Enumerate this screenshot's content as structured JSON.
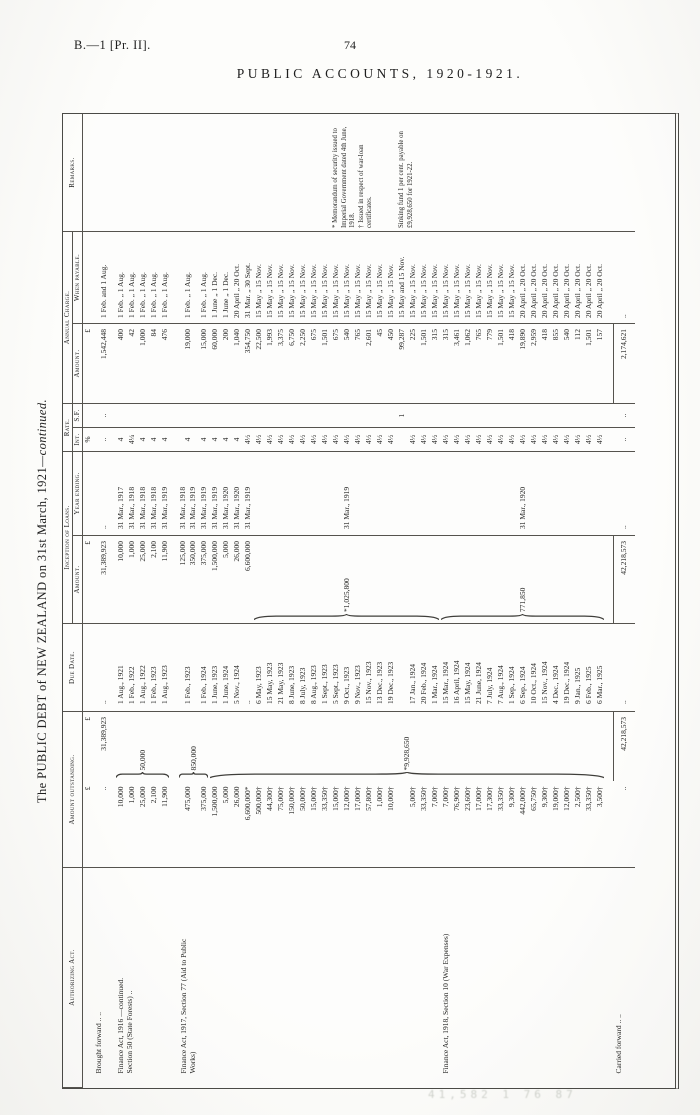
{
  "page": {
    "doc_ref": "B.—1 [Pr. II].",
    "page_number": "74",
    "accounts_heading": "PUBLIC ACCOUNTS, 1920-1921.",
    "artifact_text": "41,582 1 76 87"
  },
  "title": {
    "main": "The PUBLIC DEBT of NEW ZEALAND on 31st March, 1921",
    "continued": "—continued."
  },
  "table": {
    "headers": {
      "authorizing_act": "Authorizing Act.",
      "amount_outstanding": "Amount outstanding.",
      "due_date": "Due Date.",
      "inception_of_loans": "Inception of Loans.",
      "inception_amount": "Amount.",
      "year_ending": "Year ending.",
      "rate": "Rate.",
      "rate_int": "Int.",
      "rate_sf": "S.F.",
      "annual_charge": "Annual Charge.",
      "charge_amount": "Amount.",
      "when_payable": "When payable.",
      "remarks": "Remarks."
    },
    "rows": [
      {
        "cls": "units",
        "amt": "£",
        "tot": "£",
        "inc": "£",
        "ri": "%",
        "ch": "£"
      },
      {
        "cls": "tall1",
        "act": "Brought forward  ..  ..",
        "amt": "..",
        "tot": {
          "t": "31,389,923"
        },
        "due": "..",
        "inc": {
          "t": "31,389,923"
        },
        "yr": "..",
        "ri": "..",
        "rs": "..",
        "ch": "1,542,448",
        "pay": "1 Feb. and 1 Aug."
      },
      {
        "act": {
          "span": 5,
          "lines": [
            "Finance Act, 1916 —continued.",
            "Section 50 (State Forests)   .."
          ]
        },
        "amt": "10,000",
        "tot": {
          "t": "50,000",
          "span": 5,
          "brace": true
        },
        "due": "1 Aug., 1921",
        "inc": "10,000",
        "yr": "31 Mar., 1917",
        "ri": "4",
        "ch": "400",
        "pay": "1 Feb. „ 1 Aug."
      },
      {
        "amt": "1,000",
        "due": "1 Feb., 1922",
        "inc": "1,000",
        "yr": "31 Mar., 1918",
        "ri": "4¼",
        "ch": "42",
        "pay": "1 Feb. „ 1 Aug."
      },
      {
        "amt": "25,000",
        "due": "1 Aug., 1922",
        "inc": "25,000",
        "yr": "31 Mar., 1918",
        "ri": "4",
        "ch": "1,000",
        "pay": "1 Feb. „ 1 Aug."
      },
      {
        "amt": "2,100",
        "due": "1 Feb., 1923",
        "inc": "2,100",
        "yr": "31 Mar., 1918",
        "ri": "4",
        "ch": "84",
        "pay": "1 Feb. „ 1 Aug."
      },
      {
        "amt": "11,900",
        "due": "1 Aug., 1923",
        "inc": "11,900",
        "yr": "31 Mar., 1919",
        "ri": "4",
        "ch": "476",
        "pay": "1 Feb. „ 1 Aug."
      },
      {
        "cls": "sp"
      },
      {
        "cls": "tall2",
        "act": {
          "span": 23,
          "lines": [
            "Finance Act, 1917, Section 77 (Aid to Public",
            "Works)"
          ]
        },
        "amt": "475,000",
        "tot": {
          "t": "850,000",
          "span": 2,
          "brace": true
        },
        "due": "1 Feb., 1923",
        "inc": {
          "lines": [
            "125,000",
            "350,000"
          ]
        },
        "yr": {
          "lines": [
            "31 Mar., 1918",
            "31 Mar., 1919"
          ]
        },
        "ri": "4",
        "ch": "19,000",
        "pay": "1 Feb. „ 1 Aug."
      },
      {
        "amt": "375,000",
        "due": "1 Feb., 1924",
        "inc": "375,000",
        "yr": "31 Mar., 1919",
        "ri": "4",
        "ch": "15,000",
        "pay": "1 Feb. „ 1 Aug."
      },
      {
        "amt": "1,500,000",
        "tot": {
          "t": "*9,928,650",
          "span": 36,
          "brace": true
        },
        "due": "1 June, 1923",
        "inc": "1,500,000",
        "yr": "31 Mar., 1919",
        "ri": "4",
        "ch": "60,000",
        "pay": "1 June „ 1 Dec."
      },
      {
        "amt": "5,000",
        "due": "1 June, 1924",
        "inc": "5,000",
        "yr": "31 Mar., 1920",
        "ri": "4",
        "ch": "200",
        "pay": "1 June „ 1 Dec."
      },
      {
        "amt": "26,000",
        "due": "5 Nov., 1924",
        "inc": "26,000",
        "yr": "31 Mar., 1920",
        "ri": "4",
        "ch": "1,040",
        "pay": "20 April „ 20 Oct."
      },
      {
        "amt": "6,600,000*",
        "due": "..",
        "inc": "6,600,000",
        "yr": "31 Mar., 1919",
        "ri": "4½",
        "ch": "354,750",
        "pay": "31 Mar. „ 30 Sept."
      },
      {
        "amt": "500,000†",
        "due": "6 May, 1923",
        "inc": {
          "t": "*1,025,800",
          "span": 17,
          "brace": true
        },
        "yr": {
          "t": "31 Mar., 1919",
          "span": 17
        },
        "ri": "4½",
        "ch": "22,500",
        "pay": "15 May „ 15 Nov."
      },
      {
        "amt": "44,300†",
        "due": "15 May, 1923",
        "ri": "4½",
        "ch": "1,993",
        "pay": "15 May „ 15 Nov."
      },
      {
        "amt": "75,000†",
        "due": "21 May, 1923",
        "ri": "4½",
        "ch": "3,375",
        "pay": "15 May „ 15 Nov."
      },
      {
        "amt": "150,000†",
        "due": "8 June, 1923",
        "ri": "4½",
        "ch": "6,750",
        "pay": "15 May „ 15 Nov."
      },
      {
        "amt": "50,000†",
        "due": "8 July, 1923",
        "ri": "4½",
        "ch": "2,250",
        "pay": "15 May „ 15 Nov."
      },
      {
        "amt": "15,000†",
        "due": "8 Aug., 1923",
        "ri": "4½",
        "ch": "675",
        "pay": "15 May „ 15 Nov."
      },
      {
        "amt": "33,350†",
        "due": "1 Sept., 1923",
        "ri": "4½",
        "ch": "1,501",
        "pay": "15 May „ 15 Nov."
      },
      {
        "amt": "15,000†",
        "due": "5 Sept., 1923",
        "ri": "4½",
        "ch": "675",
        "pay": "15 May „ 15 Nov.",
        "rem": {
          "span": 6,
          "lines": [
            "* Memorandum of security issued to Imperial Government dated 4th June, 1918.",
            "† Issued in respect of war-loan certificates."
          ]
        }
      },
      {
        "amt": "12,000†",
        "due": "9 Oct., 1923",
        "ri": "4½",
        "ch": "540",
        "pay": "15 May „ 15 Nov."
      },
      {
        "amt": "17,000†",
        "due": "9 Nov., 1923",
        "ri": "4½",
        "ch": "765",
        "pay": "15 May „ 15 Nov."
      },
      {
        "amt": "57,800†",
        "due": "15 Nov., 1923",
        "ri": "4½",
        "ch": "2,601",
        "pay": "15 May „ 15 Nov."
      },
      {
        "amt": "1,000†",
        "due": "13 Dec., 1923",
        "ri": "4½",
        "ch": "45",
        "pay": "15 May „ 15 Nov."
      },
      {
        "amt": "10,000†",
        "due": "19 Dec., 1923",
        "ri": "4½",
        "ch": "450",
        "pay": "15 May „ 15 Nov."
      },
      {
        "amt": "",
        "due": "",
        "ri": "",
        "rs": "1",
        "ch": "99,287",
        "pay": "15 May and 15 Nov.",
        "rem": {
          "span": 8,
          "lines": [
            "Sinking fund 1 per cent. payable on £9,928,650 for 1921-22."
          ]
        }
      },
      {
        "amt": "5,000†",
        "due": "17 Jan., 1924",
        "ri": "4½",
        "ch": "225",
        "pay": "15 May „ 15 Nov."
      },
      {
        "amt": "33,350†",
        "due": "20 Feb., 1924",
        "ri": "4½",
        "ch": "1,501",
        "pay": "15 May „ 15 Nov."
      },
      {
        "amt": "7,000†",
        "due": "1 Mar., 1924",
        "ri": "4½",
        "ch": "315",
        "pay": "15 May „ 15 Nov."
      },
      {
        "act": {
          "span": 15,
          "lines": [
            "Finance Act, 1918, Section 10 (War Expenses)"
          ]
        },
        "amt": "7,000†",
        "due": "15 Mar., 1924",
        "inc": {
          "t": "771,850",
          "span": 15,
          "brace": true
        },
        "yr": {
          "t": "31 Mar., 1920",
          "span": 15
        },
        "ri": "4½",
        "ch": "315",
        "pay": "15 May „ 15 Nov."
      },
      {
        "amt": "76,900†",
        "due": "16 April, 1924",
        "ri": "4½",
        "ch": "3,461",
        "pay": "15 May „ 15 Nov."
      },
      {
        "amt": "23,600†",
        "due": "15 May, 1924",
        "ri": "4½",
        "ch": "1,062",
        "pay": "15 May „ 15 Nov."
      },
      {
        "amt": "17,000†",
        "due": "21 June, 1924",
        "ri": "4½",
        "ch": "765",
        "pay": "15 May „ 15 Nov."
      },
      {
        "amt": "17,300†",
        "due": "7 July, 1924",
        "ri": "4½",
        "ch": "779",
        "pay": "15 May „ 15 Nov."
      },
      {
        "amt": "33,350†",
        "due": "7 Aug., 1924",
        "ri": "4½",
        "ch": "1,501",
        "pay": "15 May „ 15 Nov."
      },
      {
        "amt": "9,300†",
        "due": "1 Sep., 1924",
        "ri": "4½",
        "ch": "418",
        "pay": "15 May „ 15 Nov."
      },
      {
        "amt": "442,000†",
        "due": "6 Sep., 1924",
        "ri": "4½",
        "ch": "19,890",
        "pay": "20 April „ 20 Oct."
      },
      {
        "amt": "65,750†",
        "due": "10 Oct., 1924",
        "ri": "4½",
        "ch": "2,959",
        "pay": "20 April „ 20 Oct."
      },
      {
        "amt": "9,300†",
        "due": "15 Nov., 1924",
        "ri": "4½",
        "ch": "418",
        "pay": "20 April „ 20 Oct."
      },
      {
        "amt": "19,000†",
        "due": "4 Dec., 1924",
        "ri": "4½",
        "ch": "855",
        "pay": "20 April „ 20 Oct."
      },
      {
        "amt": "12,000†",
        "due": "19 Dec., 1924",
        "ri": "4½",
        "ch": "540",
        "pay": "20 April „ 20 Oct."
      },
      {
        "amt": "2,500†",
        "due": "9 Jan., 1925",
        "ri": "4½",
        "ch": "112",
        "pay": "20 April „ 20 Oct."
      },
      {
        "amt": "33,350†",
        "due": "6 Feb., 1925",
        "ri": "4½",
        "ch": "1,501",
        "pay": "20 April „ 20 Oct."
      },
      {
        "amt": "3,500†",
        "due": "6 Mar., 1925",
        "ri": "4½",
        "ch": "157",
        "pay": "20 April „ 20 Oct."
      },
      {
        "cls": "sp"
      },
      {
        "cls": "tall1",
        "act": "Carried forward  ..  ..",
        "amt": "..",
        "tot": {
          "t": "42,218,573",
          "cls": "tline"
        },
        "due": "..",
        "inc": {
          "t": "42,218,573",
          "cls": "tline"
        },
        "yr": "..",
        "ri": "..",
        "rs": "..",
        "ch": {
          "t": "2,174,621",
          "cls": "tline"
        },
        "pay": ".."
      }
    ]
  }
}
